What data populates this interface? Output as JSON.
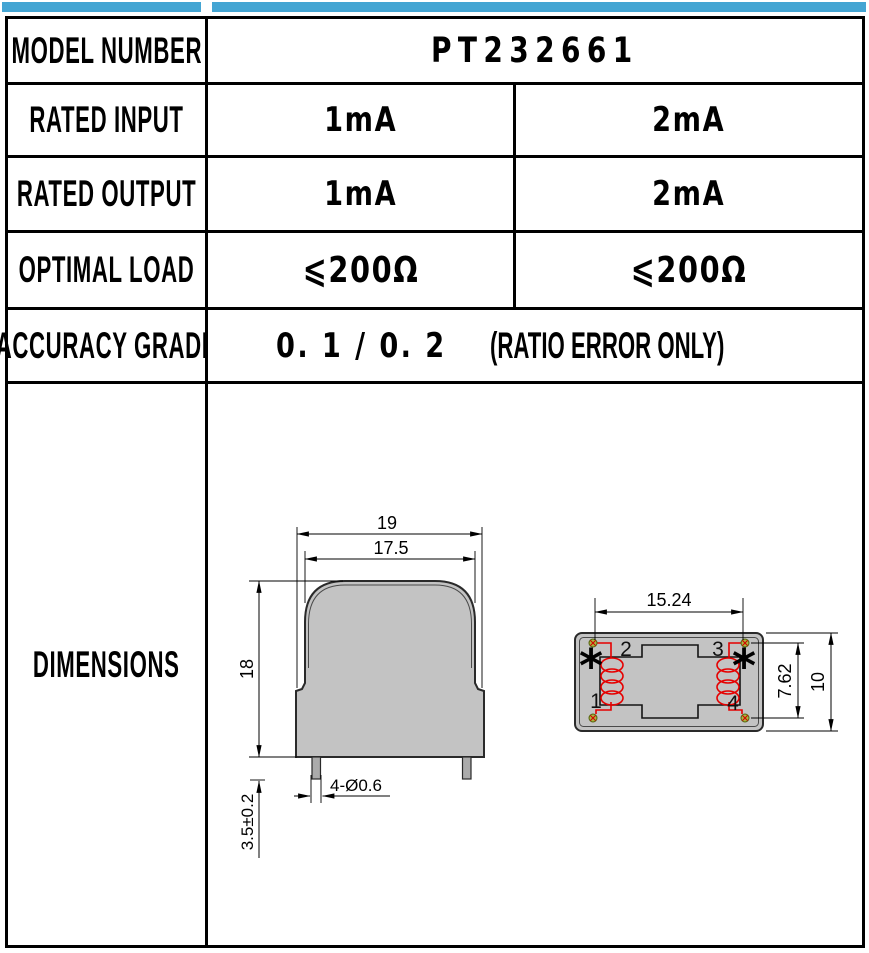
{
  "colors": {
    "accent": "#44A5D3",
    "body_gray": "#C3C3C3",
    "coil_red": "#E60000",
    "pin_green": "#A9B83C"
  },
  "table": {
    "model": {
      "label": "MODEL NUMBER",
      "value": "PT232661"
    },
    "rated_input": {
      "label": "RATED INPUT",
      "col1": "1mA",
      "col2": "2mA"
    },
    "rated_output": {
      "label": "RATED OUTPUT",
      "col1": "1mA",
      "col2": "2mA"
    },
    "optimal_load": {
      "label": "OPTIMAL LOAD",
      "col1": "⩽200Ω",
      "col2": "⩽200Ω"
    },
    "accuracy": {
      "label": "ACCURACY GRADE",
      "value": "0. 1 / 0. 2",
      "note": "(RATIO ERROR ONLY)"
    },
    "dimensions": {
      "label": "DIMENSIONS"
    }
  },
  "front_view": {
    "dim_width_outer": "19",
    "dim_width_body": "17.5",
    "dim_height": "18",
    "dim_pin_length": "3.5±0.2",
    "pin_callout": "4-Ø0.6"
  },
  "top_view": {
    "dim_pitch_x": "15.24",
    "dim_pitch_y": "7.62",
    "dim_depth": "10",
    "pin1": "1",
    "pin2": "2",
    "pin3": "3",
    "pin4": "4",
    "polarity_left": "*",
    "polarity_right": "*"
  }
}
